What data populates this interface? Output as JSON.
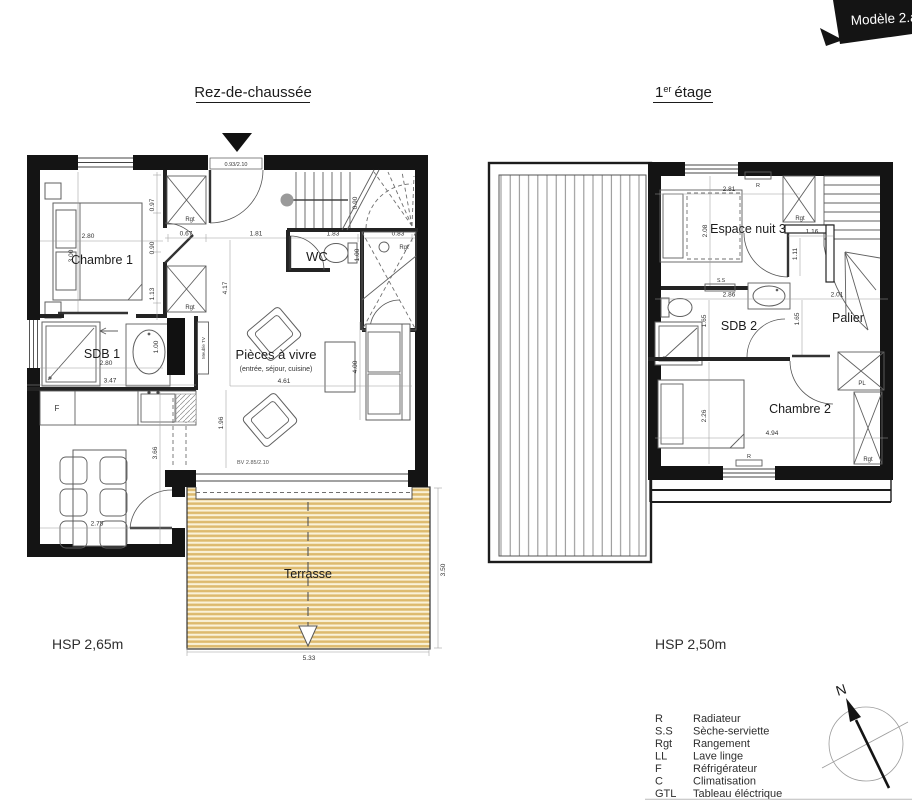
{
  "banner": {
    "label": "Modèle 2.a"
  },
  "ground": {
    "title": "Rez-de-chaussée",
    "hsp": "HSP 2,65m",
    "rooms": {
      "chambre1": "Chambre 1",
      "sdb1": "SDB 1",
      "wc": "WC",
      "living": "Pièces à vivre",
      "living_sub": "(entrée, séjour, cuisine)",
      "terrasse": "Terrasse"
    },
    "labels": {
      "rgt_hall_top": "Rgt",
      "rgt_hall_bottom": "Rgt",
      "rgt_stairs": "Rgt",
      "fridge": "F",
      "meuble_tv": "Meuble TV",
      "entry_door": "0.93/2.10",
      "bay_window": "BV 2.85/2.10"
    },
    "dims": {
      "chambre_w": "2.80",
      "chambre_h": "3.00",
      "left1": "0.97",
      "left2": "0.90",
      "left3": "1.13",
      "hall1": "0.67",
      "hall2": "1.81",
      "hall3": "1.83",
      "hall4": "0.83",
      "stairs_w": "0.90",
      "wc_w": "1.00",
      "hall_h": "4.17",
      "sdb_w": "2.80",
      "sdb_basin": "1.00",
      "kitchen_w": "3.47",
      "living_w": "4.61",
      "living_h": "4.00",
      "living_h2": "1.96",
      "dining_h": "3.66",
      "dining_w": "2.75",
      "terrasse_w": "5.33",
      "terrasse_h": "3.50"
    }
  },
  "first": {
    "title_num": "1",
    "title_sup": "er",
    "title_rest": "étage",
    "hsp": "HSP 2,50m",
    "rooms": {
      "espace_nuit": "Espace nuit 3",
      "sdb2": "SDB 2",
      "palier": "Palier",
      "chambre2": "Chambre 2"
    },
    "labels": {
      "radiator_top": "R",
      "rgt_top": "Rgt",
      "seche_serviette": "S.S",
      "placard": "PL",
      "rgt_bottom": "Rgt",
      "radiator_bottom": "R"
    },
    "dims": {
      "espace_w": "2.81",
      "espace_h": "2.08",
      "palier_top": "1.16",
      "palier_side": "1.11",
      "sdb2_w": "2.86",
      "sdb2_h": "1.65",
      "palier_w": "2.01",
      "palier_h": "1.65",
      "chambre2_h": "2.26",
      "chambre2_w": "4.94"
    }
  },
  "legend": {
    "items": [
      {
        "abbr": "R",
        "label": "Radiateur"
      },
      {
        "abbr": "S.S",
        "label": "Sèche-serviette"
      },
      {
        "abbr": "Rgt",
        "label": "Rangement"
      },
      {
        "abbr": "LL",
        "label": "Lave linge"
      },
      {
        "abbr": "F",
        "label": "Réfrigérateur"
      },
      {
        "abbr": "C",
        "label": "Climatisation"
      },
      {
        "abbr": "GTL",
        "label": "Tableau éléctrique"
      }
    ]
  },
  "compass": {
    "north": "N"
  }
}
